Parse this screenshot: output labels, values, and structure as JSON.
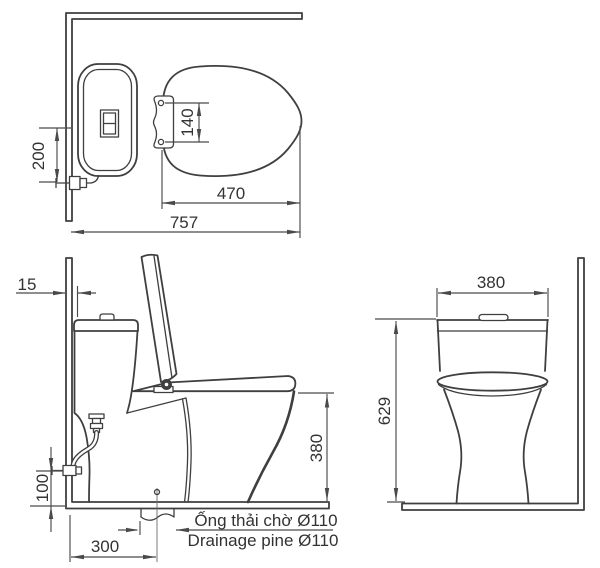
{
  "meta": {
    "bg_color": "#ffffff",
    "line_color": "#3f3f3f",
    "dim_color": "#4a4a4a",
    "text_color": "#333333"
  },
  "top_view": {
    "dim_200": "200",
    "dim_140": "140",
    "dim_470": "470",
    "dim_757": "757"
  },
  "side_view": {
    "dim_15": "15",
    "dim_100": "100",
    "dim_380": "380",
    "dim_300": "300",
    "drain_note_vi": "Ống thải chờ Ø110",
    "drain_note_en": "Drainage pine Ø110"
  },
  "front_view": {
    "dim_380": "380",
    "dim_629": "629"
  }
}
